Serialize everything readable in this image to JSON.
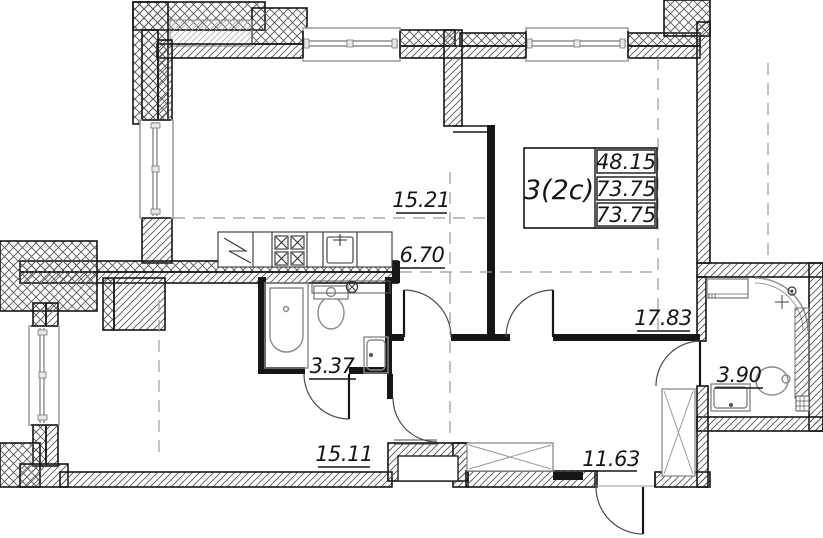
{
  "plan": {
    "unit_stamp": {
      "type_label": "3(2c)",
      "area_values": [
        "48.15",
        "73.75",
        "73.75"
      ]
    },
    "room_areas": {
      "kitchen_living": "15.21",
      "corridor": "6.70",
      "bedroom": "17.83",
      "bathroom": "3.37",
      "shower_room": "3.90",
      "living_room": "15.11",
      "hallway": "11.63"
    },
    "colors": {
      "wall": "#161616",
      "hatch": "#555555",
      "fixture": "#8a8a8a",
      "dash": "#999999",
      "background": "#ffffff"
    }
  }
}
